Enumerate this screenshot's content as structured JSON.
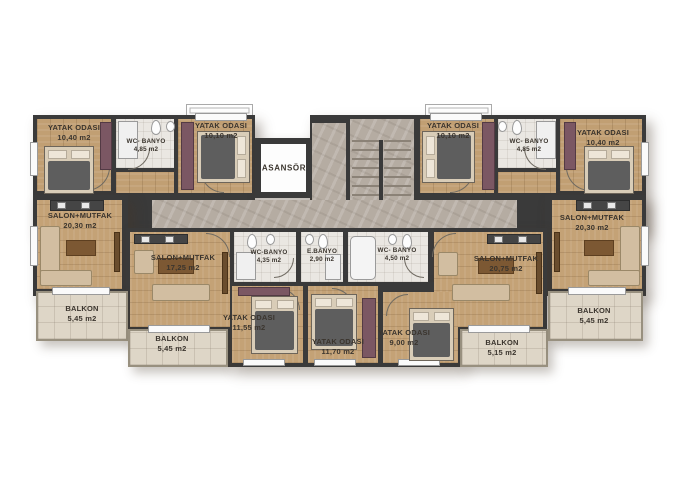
{
  "plan": {
    "elevator": {
      "label": "ASANSÖR"
    },
    "rooms": [
      {
        "name": "YATAK ODASI",
        "area": "10,40 m2"
      },
      {
        "name": "WC- BANYO",
        "area": "4,85 m2"
      },
      {
        "name": "YATAK ODASI",
        "area": "10,10 m2"
      },
      {
        "name": "YATAK ODASI",
        "area": "10,10 m2"
      },
      {
        "name": "WC- BANYO",
        "area": "4,85 m2"
      },
      {
        "name": "YATAK ODASI",
        "area": "10,40 m2"
      },
      {
        "name": "SALON+MUTFAK",
        "area": "20,30 m2"
      },
      {
        "name": "BALKON",
        "area": "5,45 m2"
      },
      {
        "name": "SALON+MUTFAK",
        "area": "17,25 m2"
      },
      {
        "name": "BALKON",
        "area": "5,45 m2"
      },
      {
        "name": "WC-BANYO",
        "area": "4,35 m2"
      },
      {
        "name": "E.BANYO",
        "area": "2,90 m2"
      },
      {
        "name": "WC- BANYO",
        "area": "4,50 m2"
      },
      {
        "name": "YATAK ODASI",
        "area": "11,55 m2"
      },
      {
        "name": "YATAK ODASI",
        "area": "11,70 m2"
      },
      {
        "name": "YATAK ODASI",
        "area": "9,00 m2"
      },
      {
        "name": "SALON+MUTFAK",
        "area": "20,75 m2"
      },
      {
        "name": "BALKON",
        "area": "5,15 m2"
      },
      {
        "name": "SALON+MUTFAK",
        "area": "20,30 m2"
      },
      {
        "name": "BALKON",
        "area": "5,45 m2"
      }
    ],
    "colors": {
      "wall": "#3a3a3a",
      "wood_floor": "#c19f73",
      "corridor": "#b5aca2",
      "balcony": "#ded6c7",
      "bathroom": "#eae7e2",
      "wardrobe": "#7b5763"
    }
  }
}
